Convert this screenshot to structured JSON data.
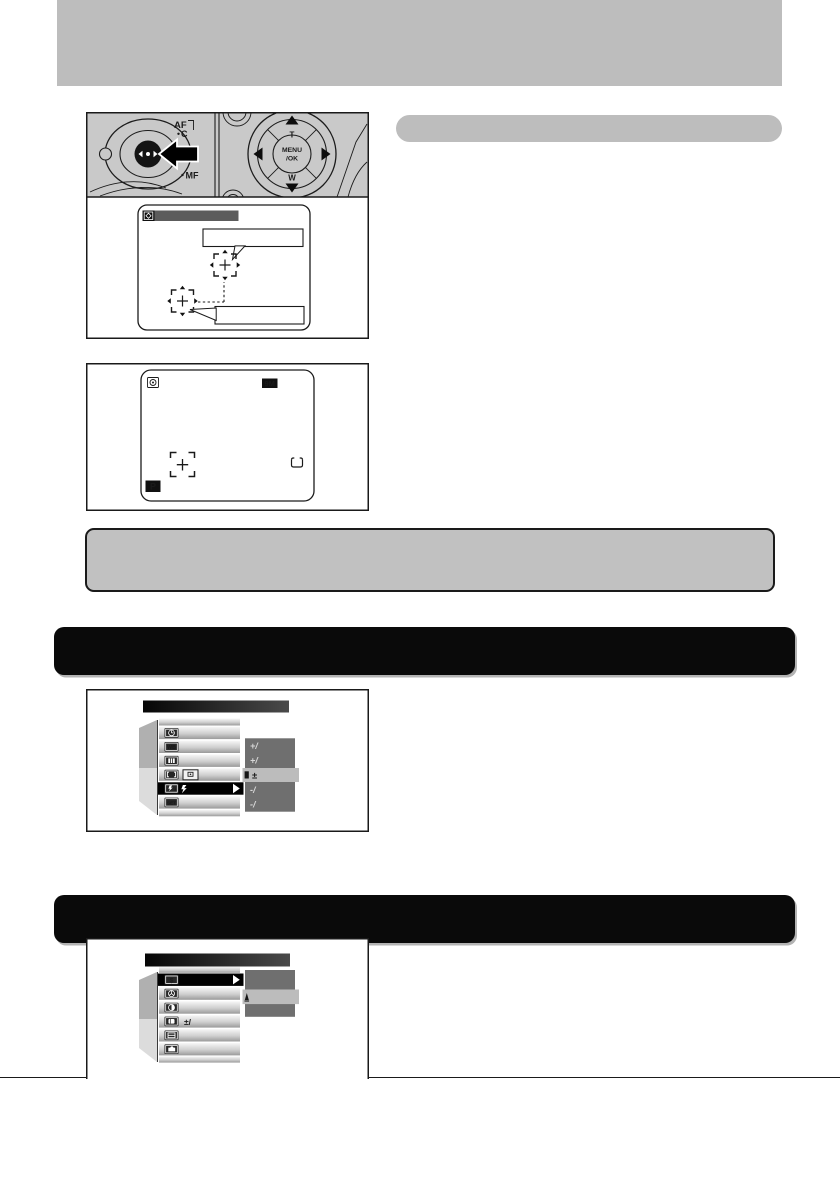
{
  "colors": {
    "banner_gray": "#bdbdbd",
    "diagram_gray": "#c9c9c9",
    "note_fill": "#c1c1c1",
    "banner_black": "#0a0a0a",
    "screen_titlebar_gray": "#5c5c5c",
    "menu_dropdown_gray": "#6f6f6f",
    "menu_highlight_gray": "#bcbcbc"
  },
  "figure1": {
    "dial_labels": {
      "af": "AF",
      "c": "C",
      "mf": "MF"
    },
    "pad_labels": {
      "top": "T",
      "bottom": "W",
      "center_line1": "MENU",
      "center_line2": "/OK"
    }
  },
  "figure2": {
    "resolution_badge": "9M",
    "mode_badge": "P"
  },
  "menu1": {
    "row2_icon_text": "WB",
    "row6_icon_text": "SET",
    "options": [
      "+/",
      "+/",
      "±",
      "-/",
      "-/"
    ]
  },
  "menu2": {
    "row1_icon_text": "$",
    "row4_value": "±/"
  }
}
